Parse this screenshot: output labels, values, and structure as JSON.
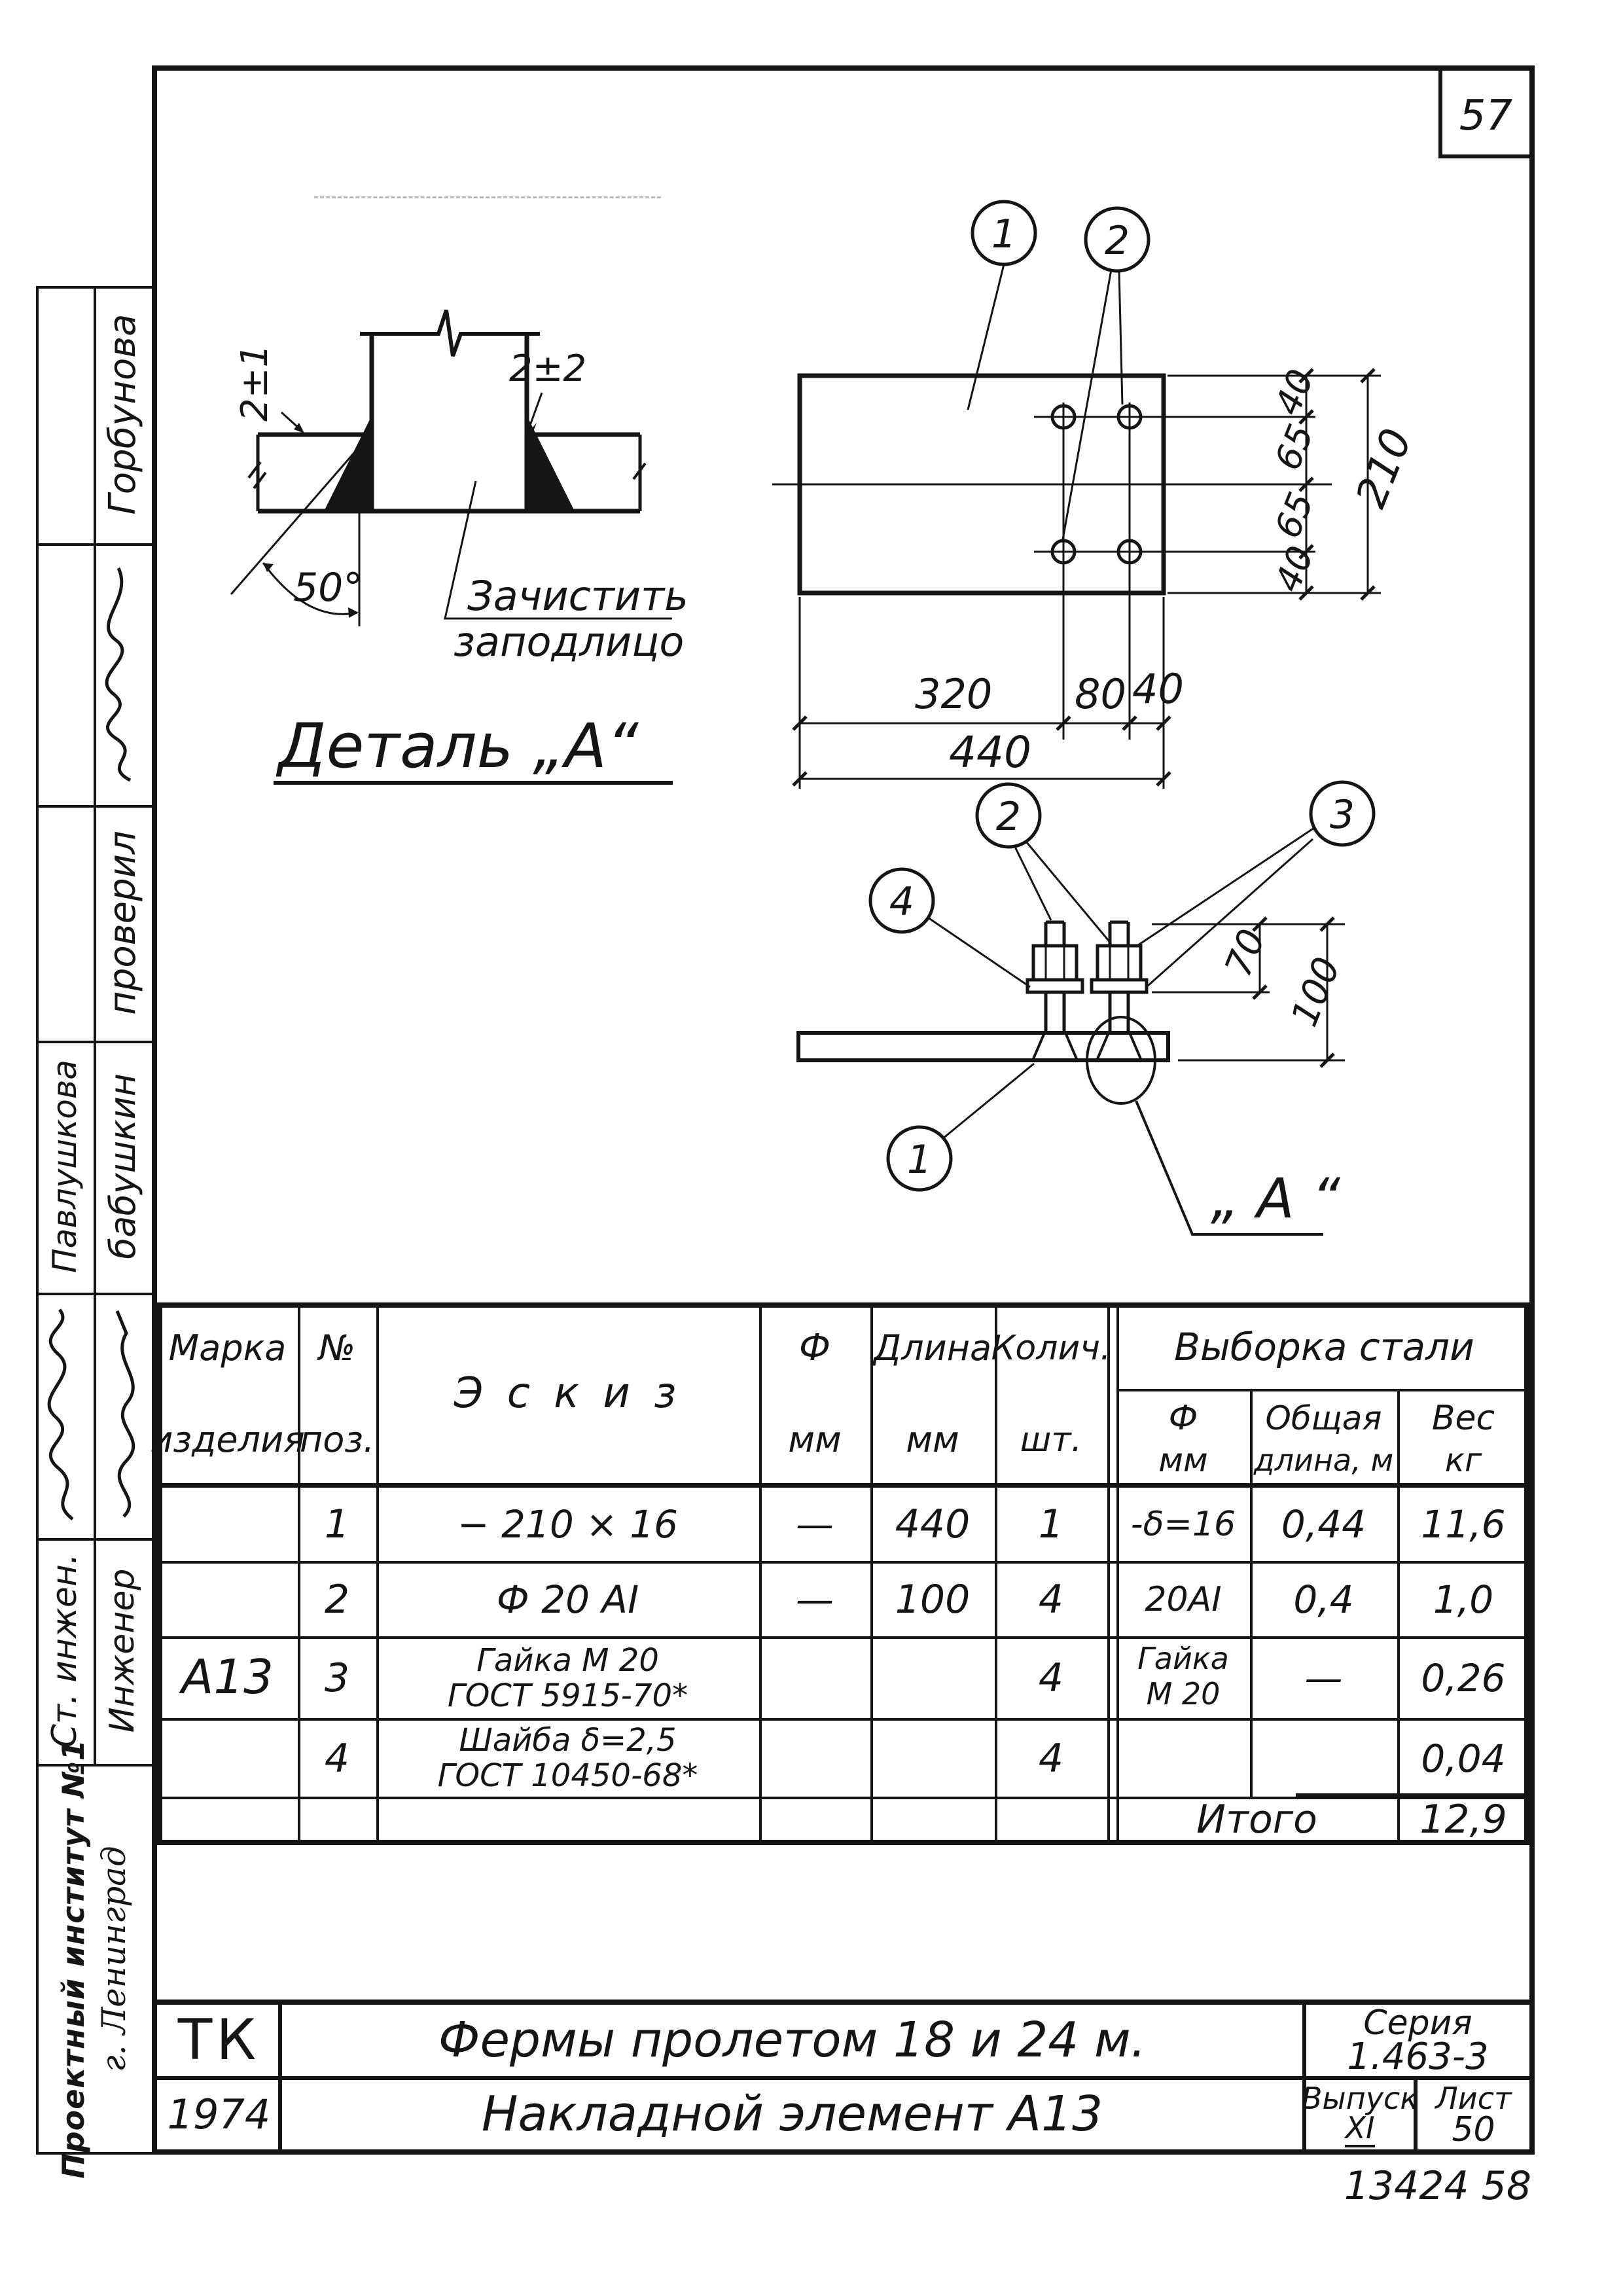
{
  "page": {
    "sheet_number": "57",
    "doc_code": "13424  58"
  },
  "sidebar": {
    "name_top": "Горбунова",
    "checked_label": "проверил",
    "name_left": "Павлушкова",
    "name_right": "бабушкин",
    "role_left": "Ст. инжен.",
    "role_right": "Инженер",
    "institute": "Проектный институт №1",
    "city": "г. Ленинград"
  },
  "detail_a": {
    "title": "Деталь „А“",
    "gap_top": "2±2",
    "gap_left": "2±1",
    "angle": "50°",
    "note1": "Зачистить",
    "note2": "заподлицо"
  },
  "plan_view": {
    "callout_1": "1",
    "callout_2": "2",
    "dim_320": "320",
    "dim_80": "80",
    "dim_40_bottom": "40",
    "dim_440": "440",
    "dim_40_top": "40",
    "dim_65_a": "65",
    "dim_65_b": "65",
    "dim_40_low": "40",
    "dim_210": "210"
  },
  "side_view": {
    "callout_1": "1",
    "callout_2": "2",
    "callout_3": "3",
    "callout_4": "4",
    "dim_70": "70",
    "dim_100": "100",
    "label_a": "„ А “"
  },
  "table": {
    "h_marka1": "Марка",
    "h_marka2": "изделия",
    "h_pos1": "№",
    "h_pos2": "поз.",
    "h_sketch": "Э с к и з",
    "h_d1": "Ф",
    "h_d2": "мм",
    "h_len1": "Длина",
    "h_len2": "мм",
    "h_qty1": "Колич.",
    "h_qty2": "шт.",
    "h_group": "Выборка  стали",
    "h_gd1": "Ф",
    "h_gd2": "мм",
    "h_gl1": "Общая",
    "h_gl2": "длина, м",
    "h_gw1": "Вес",
    "h_gw2": "кг",
    "marka": "А13",
    "rows": [
      {
        "pos": "1",
        "sk1": "− 210 × 16",
        "sk2": "",
        "d": "—",
        "len": "440",
        "qty": "1",
        "gd1": "-δ=16",
        "gd2": "",
        "gl": "0,44",
        "gw": "11,6"
      },
      {
        "pos": "2",
        "sk1": "Ф 20 АI",
        "sk2": "",
        "d": "—",
        "len": "100",
        "qty": "4",
        "gd1": "20АI",
        "gd2": "",
        "gl": "0,4",
        "gw": "1,0"
      },
      {
        "pos": "3",
        "sk1": "Гайка  М 20",
        "sk2": "ГОСТ 5915-70*",
        "d": "",
        "len": "",
        "qty": "4",
        "gd1": "Гайка",
        "gd2": "М 20",
        "gl": "—",
        "gw": "0,26"
      },
      {
        "pos": "4",
        "sk1": "Шайба  δ=2,5",
        "sk2": "ГОСТ 10450-68*",
        "d": "",
        "len": "",
        "qty": "4",
        "gd1": "",
        "gd2": "",
        "gl": "",
        "gw": "0,04"
      }
    ],
    "total_label": "Итого",
    "total_value": "12,9"
  },
  "stamp": {
    "org_abbr": "ТК",
    "year": "1974",
    "title_line1": "Фермы  пролетом  18 и 24 м.",
    "title_line2": "Накладной  элемент  А13",
    "series_label": "Серия",
    "series_value": "1.463-3",
    "issue_label": "Выпуск",
    "issue_value": "XI",
    "sheet_label": "Лист",
    "sheet_value": "50"
  }
}
